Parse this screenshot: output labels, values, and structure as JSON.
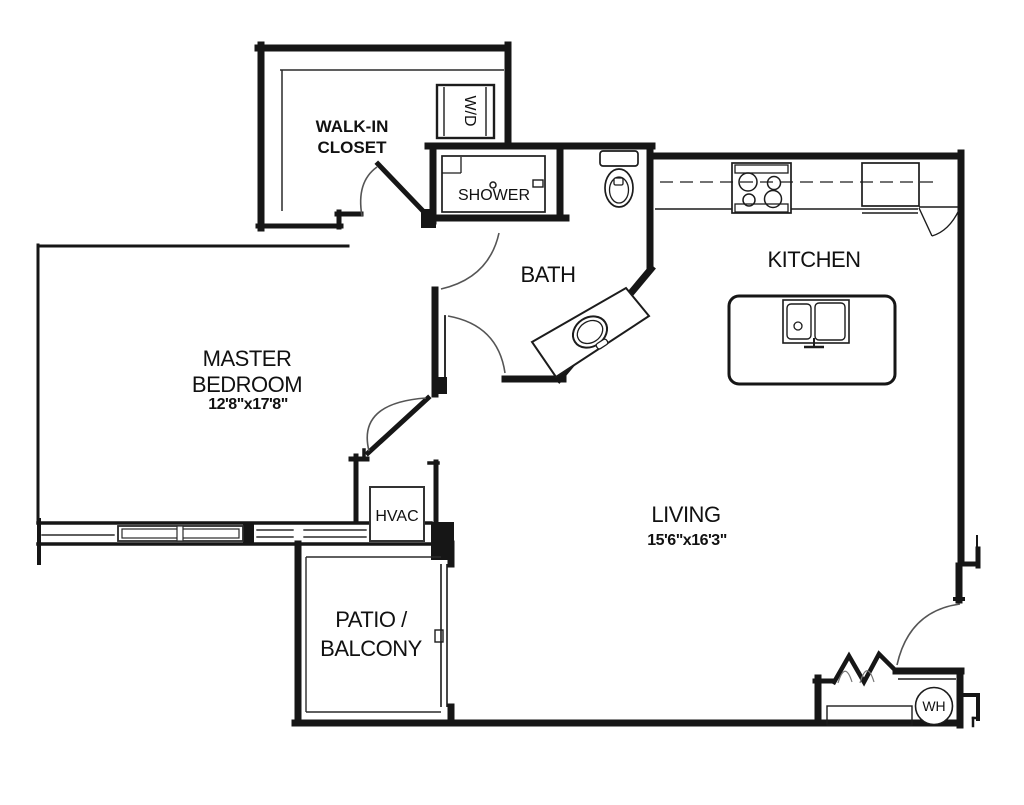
{
  "floor_plan": {
    "colors": {
      "wall": "#161616",
      "thin_line": "#2a2a2a",
      "door_arc": "#555555",
      "background": "#ffffff"
    },
    "rooms": {
      "walk_in_closet": {
        "line1": "WALK-IN",
        "line2": "CLOSET"
      },
      "shower": {
        "label": "SHOWER"
      },
      "bath": {
        "label": "BATH"
      },
      "kitchen": {
        "label": "KITCHEN"
      },
      "master_bedroom": {
        "line1": "MASTER",
        "line2": "BEDROOM",
        "dims": "12'8\"x17'8\""
      },
      "living": {
        "label": "LIVING",
        "dims": "15'6\"x16'3\""
      },
      "patio": {
        "line1": "PATIO /",
        "line2": "BALCONY"
      },
      "hvac": {
        "label": "HVAC"
      },
      "washer_dryer": {
        "label": "W/D"
      },
      "water_heater": {
        "label": "WH"
      }
    }
  }
}
